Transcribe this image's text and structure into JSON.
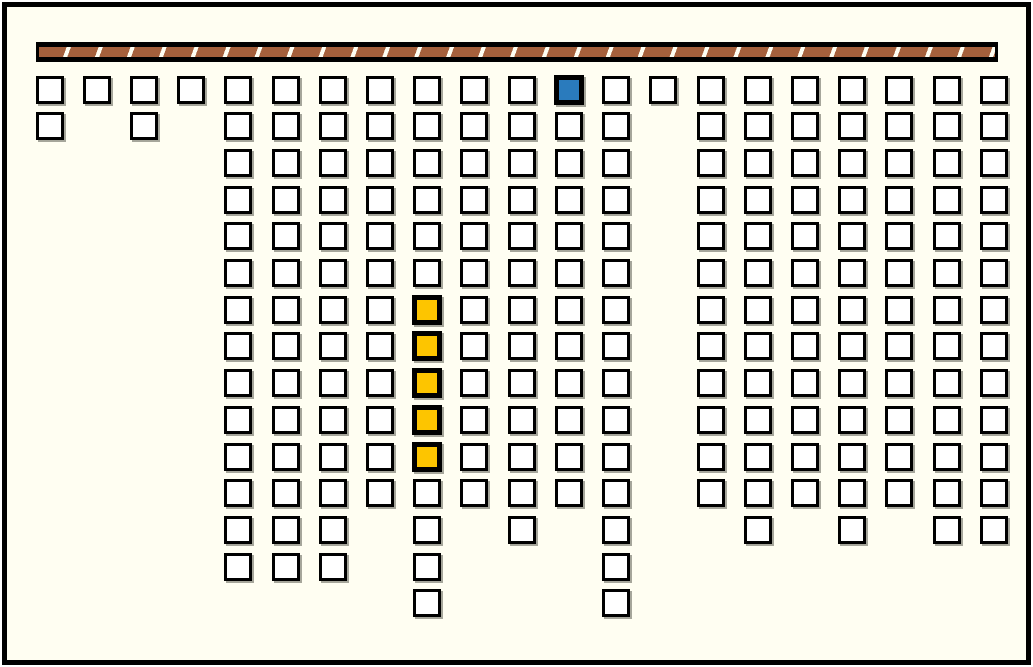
{
  "canvas": {
    "width": 1033,
    "height": 667
  },
  "colors": {
    "page_margin": "#FFFFFF",
    "background": "#FFFEF2",
    "frame_border": "#000000",
    "cell_fill": "#FFFFFF",
    "cell_border": "#000000",
    "cell_shadow": "#A6A69B",
    "selected_blue": "#2A7BBD",
    "highlight_yellow": "#FDC500",
    "wall_fill": "#A5603C",
    "wall_stripe": "#FFFEF2",
    "wall_border": "#000000"
  },
  "wall_bar": {
    "x": 36,
    "y": 42,
    "width": 962,
    "height": 20,
    "segment_pitch": 32,
    "stripe_width": 4
  },
  "grid": {
    "origin_x": 35.5,
    "origin_y": 75.5,
    "col_pitch": 47.22,
    "row_pitch": 36.7,
    "cell_size": 28,
    "num_columns": 21,
    "max_rows": 15,
    "column_lengths": [
      2,
      1,
      2,
      1,
      14,
      14,
      14,
      12,
      15,
      12,
      13,
      12,
      15,
      1,
      12,
      13,
      12,
      13,
      12,
      13,
      13
    ],
    "total_cells": 216,
    "special_cells": [
      {
        "col": 12,
        "row": 1,
        "state": "blue"
      },
      {
        "col": 9,
        "row": 7,
        "state": "yellow"
      },
      {
        "col": 9,
        "row": 8,
        "state": "yellow"
      },
      {
        "col": 9,
        "row": 9,
        "state": "yellow"
      },
      {
        "col": 9,
        "row": 10,
        "state": "yellow"
      },
      {
        "col": 9,
        "row": 11,
        "state": "yellow"
      }
    ]
  }
}
